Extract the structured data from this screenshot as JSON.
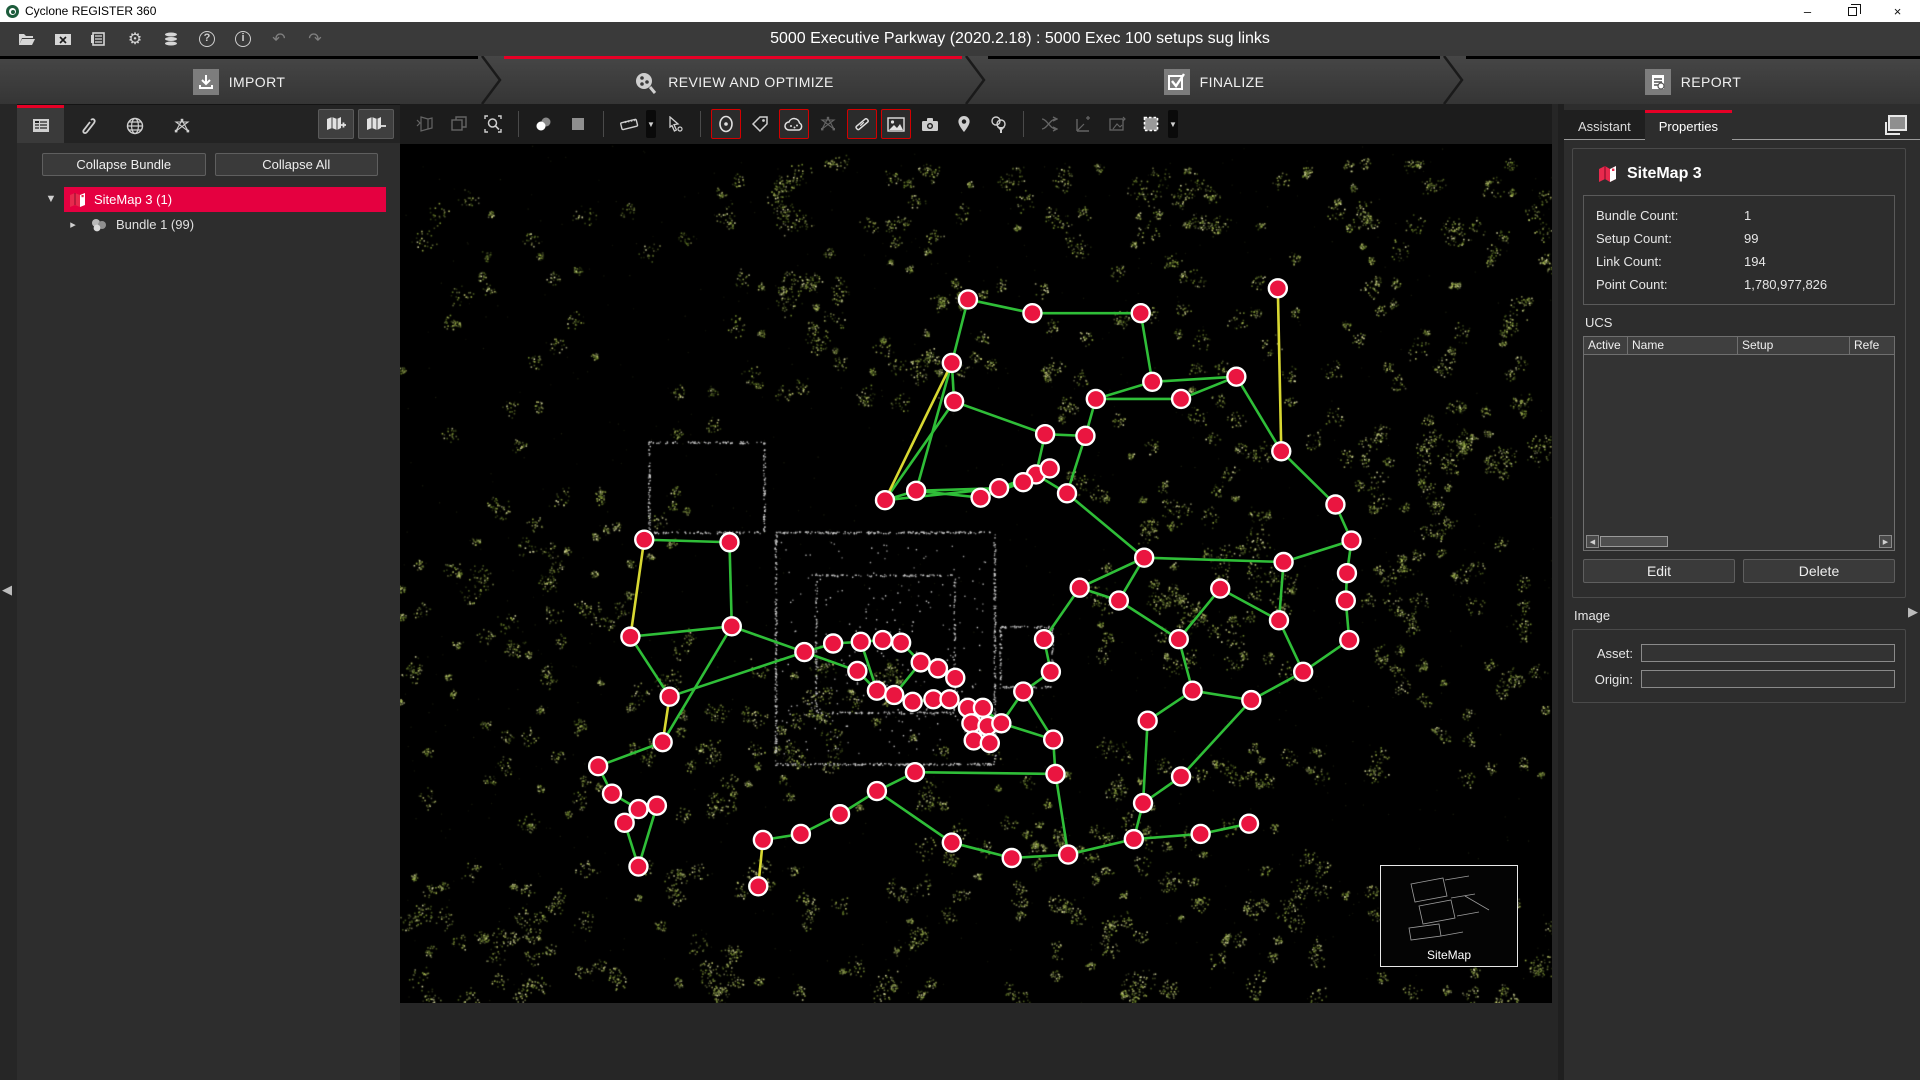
{
  "window": {
    "app_title": "Cyclone REGISTER 360",
    "controls": {
      "minimize": "–",
      "restore": "restore",
      "close": "×"
    }
  },
  "menubar": {
    "document_title": "5000 Executive Parkway (2020.2.18) : 5000 Exec 100 setups sug links",
    "accent_red": "#e60026"
  },
  "workflow_tabs": [
    {
      "label": "IMPORT",
      "active": false
    },
    {
      "label": "REVIEW AND OPTIMIZE",
      "active": true
    },
    {
      "label": "FINALIZE",
      "active": false
    },
    {
      "label": "REPORT",
      "active": false
    }
  ],
  "left_panel": {
    "collapse_bundle_label": "Collapse Bundle",
    "collapse_all_label": "Collapse All",
    "tree": [
      {
        "label": "SiteMap 3 (1)",
        "selected": true
      },
      {
        "label": "Bundle 1 (99)",
        "selected": false
      }
    ]
  },
  "right_panel": {
    "tabs": [
      {
        "label": "Assistant",
        "active": false
      },
      {
        "label": "Properties",
        "active": true
      }
    ],
    "properties": {
      "title": "SiteMap 3",
      "stats": [
        {
          "label": "Bundle Count:",
          "value": "1"
        },
        {
          "label": "Setup Count:",
          "value": "99"
        },
        {
          "label": "Link Count:",
          "value": "194"
        },
        {
          "label": "Point Count:",
          "value": "1,780,977,826"
        }
      ]
    },
    "ucs": {
      "section_label": "UCS",
      "columns": [
        "Active",
        "Name",
        "Setup",
        "Refe"
      ],
      "rows": [],
      "edit_label": "Edit",
      "delete_label": "Delete"
    },
    "image": {
      "section_label": "Image",
      "asset_label": "Asset:",
      "origin_label": "Origin:",
      "asset_value": "",
      "origin_value": ""
    }
  },
  "canvas": {
    "sitemap_label": "SiteMap",
    "active_tools": [
      "setup-visibility",
      "pointcloud-visibility",
      "link-visibility",
      "image-visibility"
    ],
    "colors": {
      "node_fill": "#ea1540",
      "node_ring": "#ffffff",
      "link_green": "#2fbe38",
      "link_yellow": "#d8d832"
    },
    "nodes": [
      [
        49.3,
        18.0
      ],
      [
        54.9,
        19.6
      ],
      [
        64.3,
        19.6
      ],
      [
        76.2,
        16.7
      ],
      [
        47.9,
        25.4
      ],
      [
        72.6,
        27.0
      ],
      [
        65.3,
        27.6
      ],
      [
        48.1,
        29.9
      ],
      [
        60.4,
        29.6
      ],
      [
        67.8,
        29.6
      ],
      [
        56.0,
        33.7
      ],
      [
        59.5,
        33.9
      ],
      [
        76.5,
        35.7
      ],
      [
        42.1,
        41.4
      ],
      [
        44.8,
        40.3
      ],
      [
        50.4,
        41.1
      ],
      [
        52.0,
        40.0
      ],
      [
        55.2,
        38.4
      ],
      [
        57.9,
        40.6
      ],
      [
        56.4,
        37.7
      ],
      [
        54.1,
        39.3
      ],
      [
        81.2,
        41.9
      ],
      [
        21.2,
        46.0
      ],
      [
        28.6,
        46.3
      ],
      [
        82.6,
        46.1
      ],
      [
        64.6,
        48.1
      ],
      [
        76.7,
        48.6
      ],
      [
        82.2,
        49.9
      ],
      [
        20.0,
        57.3
      ],
      [
        23.4,
        64.3
      ],
      [
        28.8,
        56.1
      ],
      [
        35.1,
        59.1
      ],
      [
        37.6,
        58.1
      ],
      [
        40.0,
        57.9
      ],
      [
        41.9,
        57.7
      ],
      [
        43.5,
        58.0
      ],
      [
        45.2,
        60.3
      ],
      [
        46.7,
        61.0
      ],
      [
        48.2,
        62.1
      ],
      [
        39.7,
        61.3
      ],
      [
        41.4,
        63.6
      ],
      [
        42.9,
        64.1
      ],
      [
        44.5,
        64.9
      ],
      [
        46.3,
        64.6
      ],
      [
        47.7,
        64.6
      ],
      [
        49.3,
        65.6
      ],
      [
        50.6,
        65.6
      ],
      [
        49.6,
        67.4
      ],
      [
        51.0,
        67.7
      ],
      [
        49.8,
        69.4
      ],
      [
        51.2,
        69.7
      ],
      [
        52.2,
        67.4
      ],
      [
        54.1,
        63.7
      ],
      [
        56.5,
        61.4
      ],
      [
        55.9,
        57.6
      ],
      [
        59.0,
        51.6
      ],
      [
        62.4,
        53.1
      ],
      [
        67.6,
        57.6
      ],
      [
        71.2,
        51.7
      ],
      [
        76.3,
        55.4
      ],
      [
        82.1,
        53.1
      ],
      [
        82.4,
        57.7
      ],
      [
        78.4,
        61.4
      ],
      [
        73.9,
        64.7
      ],
      [
        68.8,
        63.6
      ],
      [
        64.9,
        67.1
      ],
      [
        56.7,
        69.3
      ],
      [
        56.9,
        73.3
      ],
      [
        44.7,
        73.1
      ],
      [
        41.4,
        75.3
      ],
      [
        22.8,
        69.6
      ],
      [
        17.2,
        72.4
      ],
      [
        18.4,
        75.6
      ],
      [
        20.7,
        77.4
      ],
      [
        22.3,
        77.0
      ],
      [
        19.5,
        79.0
      ],
      [
        31.5,
        81.0
      ],
      [
        34.8,
        80.3
      ],
      [
        38.2,
        78.0
      ],
      [
        47.9,
        81.3
      ],
      [
        53.1,
        83.1
      ],
      [
        58.0,
        82.7
      ],
      [
        63.7,
        80.9
      ],
      [
        69.5,
        80.3
      ],
      [
        73.7,
        79.1
      ],
      [
        64.5,
        76.7
      ],
      [
        67.8,
        73.6
      ],
      [
        20.7,
        84.1
      ],
      [
        31.1,
        86.4
      ]
    ],
    "links": [
      [
        0,
        1
      ],
      [
        1,
        2
      ],
      [
        0,
        4
      ],
      [
        4,
        7
      ],
      [
        7,
        10
      ],
      [
        7,
        13
      ],
      [
        4,
        14
      ],
      [
        2,
        6
      ],
      [
        6,
        5
      ],
      [
        5,
        9
      ],
      [
        9,
        8
      ],
      [
        8,
        11
      ],
      [
        10,
        11
      ],
      [
        11,
        18
      ],
      [
        10,
        17
      ],
      [
        8,
        6
      ],
      [
        3,
        12,
        "y"
      ],
      [
        5,
        12
      ],
      [
        12,
        21
      ],
      [
        21,
        24
      ],
      [
        24,
        27
      ],
      [
        27,
        60
      ],
      [
        60,
        61
      ],
      [
        61,
        62
      ],
      [
        13,
        14
      ],
      [
        14,
        15
      ],
      [
        15,
        16
      ],
      [
        16,
        17
      ],
      [
        17,
        19
      ],
      [
        19,
        20
      ],
      [
        20,
        16
      ],
      [
        15,
        20
      ],
      [
        13,
        16
      ],
      [
        14,
        16
      ],
      [
        17,
        18
      ],
      [
        18,
        25
      ],
      [
        4,
        13,
        "y"
      ],
      [
        25,
        26
      ],
      [
        26,
        59
      ],
      [
        24,
        26
      ],
      [
        25,
        55
      ],
      [
        55,
        56
      ],
      [
        25,
        56
      ],
      [
        56,
        57
      ],
      [
        57,
        58
      ],
      [
        58,
        59
      ],
      [
        59,
        62
      ],
      [
        62,
        63
      ],
      [
        63,
        64
      ],
      [
        64,
        65
      ],
      [
        65,
        85
      ],
      [
        85,
        86
      ],
      [
        86,
        63
      ],
      [
        57,
        64
      ],
      [
        54,
        55
      ],
      [
        53,
        54
      ],
      [
        52,
        53
      ],
      [
        51,
        52
      ],
      [
        22,
        23
      ],
      [
        22,
        28,
        "y"
      ],
      [
        23,
        30
      ],
      [
        28,
        30
      ],
      [
        28,
        29
      ],
      [
        30,
        31
      ],
      [
        29,
        31
      ],
      [
        31,
        32
      ],
      [
        32,
        33
      ],
      [
        33,
        34
      ],
      [
        34,
        35
      ],
      [
        35,
        36
      ],
      [
        36,
        37
      ],
      [
        37,
        38
      ],
      [
        31,
        39
      ],
      [
        39,
        40
      ],
      [
        40,
        41
      ],
      [
        41,
        42
      ],
      [
        42,
        43
      ],
      [
        43,
        44
      ],
      [
        44,
        45
      ],
      [
        45,
        46
      ],
      [
        46,
        48
      ],
      [
        47,
        48
      ],
      [
        49,
        50
      ],
      [
        46,
        51
      ],
      [
        45,
        47
      ],
      [
        47,
        49
      ],
      [
        48,
        50
      ],
      [
        36,
        41
      ],
      [
        33,
        40
      ],
      [
        51,
        66
      ],
      [
        66,
        67
      ],
      [
        52,
        66
      ],
      [
        67,
        68
      ],
      [
        68,
        69
      ],
      [
        69,
        78
      ],
      [
        78,
        77
      ],
      [
        77,
        76
      ],
      [
        76,
        88,
        "y"
      ],
      [
        69,
        79
      ],
      [
        67,
        81
      ],
      [
        79,
        80
      ],
      [
        80,
        81
      ],
      [
        81,
        82
      ],
      [
        82,
        83
      ],
      [
        83,
        84
      ],
      [
        82,
        85
      ],
      [
        70,
        71
      ],
      [
        71,
        72
      ],
      [
        72,
        73
      ],
      [
        73,
        74
      ],
      [
        74,
        75
      ],
      [
        70,
        29,
        "y"
      ],
      [
        74,
        87
      ],
      [
        75,
        87
      ],
      [
        70,
        30
      ]
    ]
  }
}
